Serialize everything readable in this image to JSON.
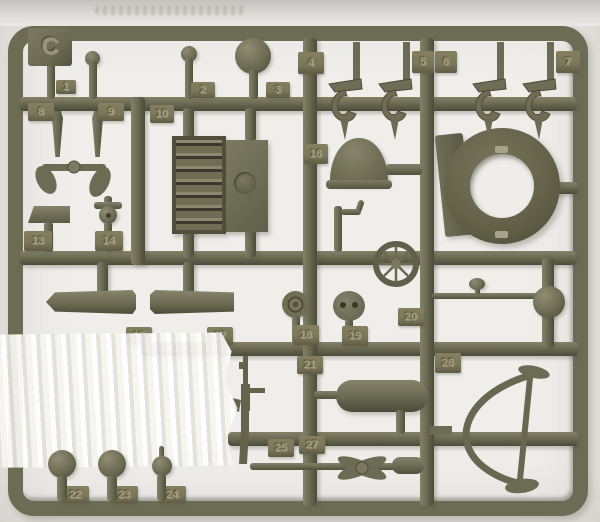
{
  "photo_subject": "olive drab plastic model kit sprue C with numbered parts and white tape strip",
  "sprue": {
    "letter": "C",
    "material_color": "#6c6b53",
    "shadow_color": "#4c4b39",
    "highlight_color": "#8b8a6e",
    "tag_color": "#79765a",
    "tags": [
      {
        "label": "1",
        "x": 56,
        "y": 80,
        "w": 20,
        "h": 14
      },
      {
        "label": "2",
        "x": 191,
        "y": 82,
        "w": 24,
        "h": 16
      },
      {
        "label": "3",
        "x": 266,
        "y": 82,
        "w": 24,
        "h": 16
      },
      {
        "label": "4",
        "x": 298,
        "y": 52,
        "w": 26,
        "h": 22
      },
      {
        "label": "5",
        "x": 412,
        "y": 51,
        "w": 22,
        "h": 22
      },
      {
        "label": "6",
        "x": 435,
        "y": 51,
        "w": 22,
        "h": 22
      },
      {
        "label": "7",
        "x": 556,
        "y": 51,
        "w": 24,
        "h": 22
      },
      {
        "label": "8",
        "x": 28,
        "y": 103,
        "w": 26,
        "h": 18
      },
      {
        "label": "9",
        "x": 98,
        "y": 103,
        "w": 26,
        "h": 18
      },
      {
        "label": "10",
        "x": 150,
        "y": 105,
        "w": 24,
        "h": 18
      },
      {
        "label": "13",
        "x": 24,
        "y": 231,
        "w": 28,
        "h": 20
      },
      {
        "label": "14",
        "x": 95,
        "y": 231,
        "w": 28,
        "h": 20
      },
      {
        "label": "16",
        "x": 304,
        "y": 144,
        "w": 24,
        "h": 20
      },
      {
        "label": "15",
        "x": 126,
        "y": 327,
        "w": 26,
        "h": 18
      },
      {
        "label": "17",
        "x": 207,
        "y": 327,
        "w": 26,
        "h": 18
      },
      {
        "label": "18",
        "x": 293,
        "y": 325,
        "w": 26,
        "h": 20
      },
      {
        "label": "19",
        "x": 342,
        "y": 326,
        "w": 26,
        "h": 20
      },
      {
        "label": "20",
        "x": 398,
        "y": 308,
        "w": 26,
        "h": 18
      },
      {
        "label": "21",
        "x": 297,
        "y": 356,
        "w": 26,
        "h": 18
      },
      {
        "label": "25",
        "x": 268,
        "y": 439,
        "w": 26,
        "h": 18
      },
      {
        "label": "27",
        "x": 299,
        "y": 436,
        "w": 26,
        "h": 18
      },
      {
        "label": "26",
        "x": 435,
        "y": 353,
        "w": 26,
        "h": 20
      },
      {
        "label": "22",
        "x": 62,
        "y": 486,
        "w": 27,
        "h": 17
      },
      {
        "label": "23",
        "x": 111,
        "y": 486,
        "w": 27,
        "h": 17
      },
      {
        "label": "24",
        "x": 159,
        "y": 486,
        "w": 27,
        "h": 17
      }
    ]
  },
  "tape": {
    "color": "#f6f5f1"
  },
  "background_color": "#f0eeeb"
}
